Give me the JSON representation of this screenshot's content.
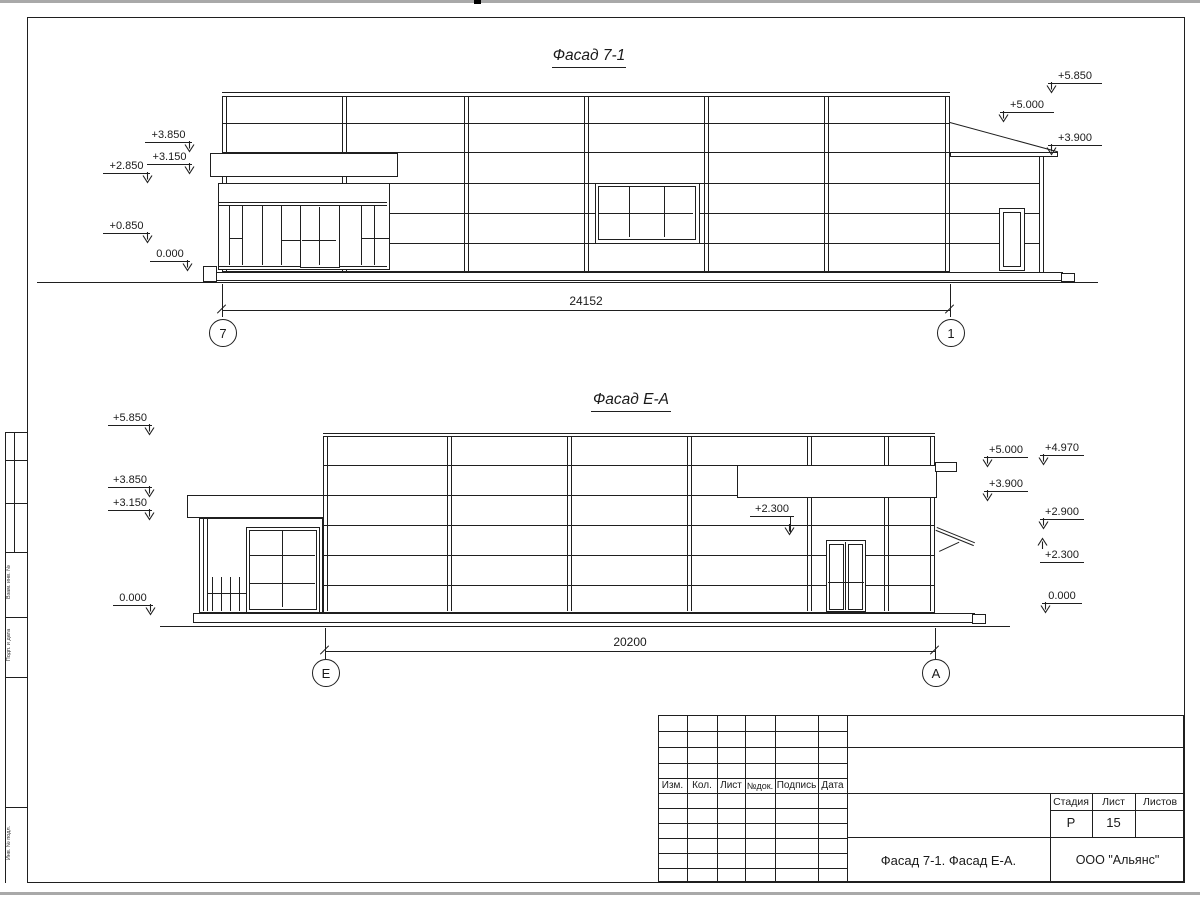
{
  "colors": {
    "line": "#1f1f1f",
    "paper": "#ffffff"
  },
  "facade1": {
    "title": "Фасад 7-1",
    "dimension": "24152",
    "axis_left": "7",
    "axis_right": "1",
    "elev_left": [
      "+3.850",
      "+3.150",
      "+2.850",
      "+0.850",
      "0.000"
    ],
    "elev_right": [
      "+5.850",
      "+5.000",
      "+3.900"
    ]
  },
  "facade2": {
    "title": "Фасад Е-А",
    "dimension": "20200",
    "axis_left": "Е",
    "axis_right": "А",
    "elev_left": [
      "+5.850",
      "+3.850",
      "+3.150",
      "0.000"
    ],
    "elev_right": [
      "+5.000",
      "+4.970",
      "+3.900",
      "+2.900",
      "+2.300",
      "0.000"
    ],
    "elev_inner": "+2.300"
  },
  "title_block": {
    "revision_columns": [
      "Изм.",
      "Кол.",
      "Лист",
      "№док.",
      "Подпись",
      "Дата"
    ],
    "stage_label": "Стадия",
    "sheet_label": "Лист",
    "sheets_label": "Листов",
    "stage_value": "Р",
    "sheet_value": "15",
    "doc_title": "Фасад 7-1. Фасад Е-А.",
    "company": "ООО \"Альянс\""
  },
  "frame": {
    "side_labels": [
      "Взам. инв. №",
      "Подп. и дата",
      "Инв. № подл."
    ]
  }
}
